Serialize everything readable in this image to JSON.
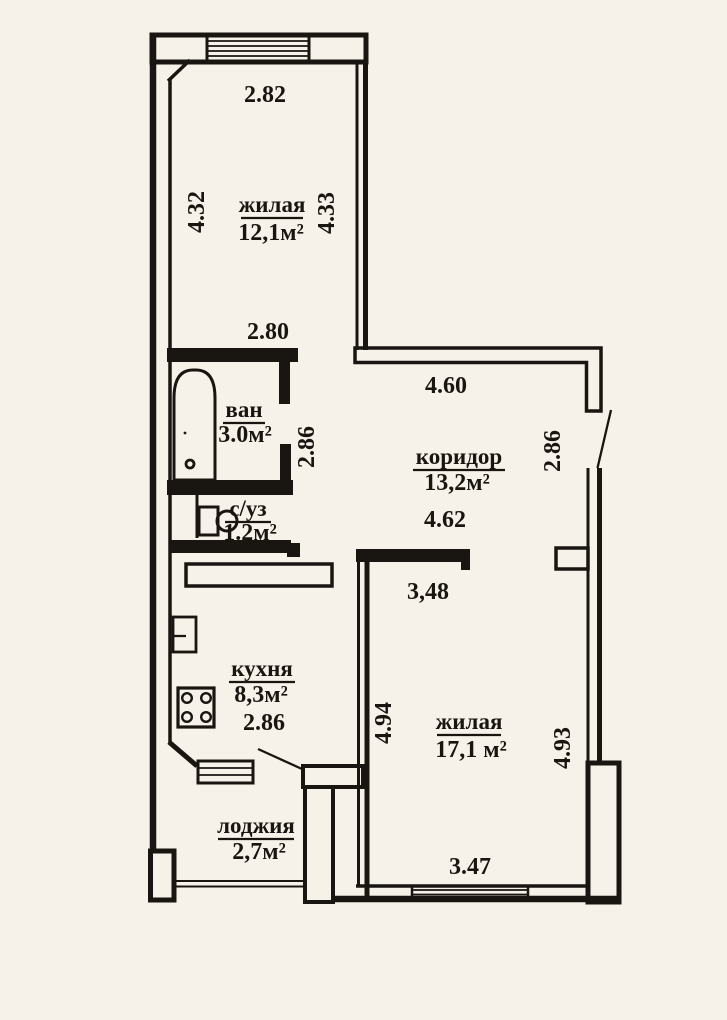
{
  "document_type": "apartment floor plan",
  "colors": {
    "paper": "#f6f2e9",
    "ink": "#191511"
  },
  "rooms": [
    {
      "name": "жилая",
      "area": "12,1м²"
    },
    {
      "name": "ван",
      "area": "3.0м²"
    },
    {
      "name": "с/уз",
      "area": "1.2м²"
    },
    {
      "name": "коридор",
      "area": "13,2м²"
    },
    {
      "name": "кухня",
      "area": "8,3м²"
    },
    {
      "name": "жилая",
      "area": "17,1 м²"
    },
    {
      "name": "лоджия",
      "area": "2,7м²"
    }
  ],
  "dimensions": [
    "2.82",
    "4.32",
    "4.33",
    "2.80",
    "2.86",
    "4.60",
    "2.86",
    "4.62",
    "3,48",
    "2.86",
    "4.94",
    "4.93",
    "3.47"
  ],
  "fixtures": [
    "bathtub",
    "toilet",
    "stove",
    "sink",
    "window",
    "door-leaf",
    "loggia-railing"
  ]
}
